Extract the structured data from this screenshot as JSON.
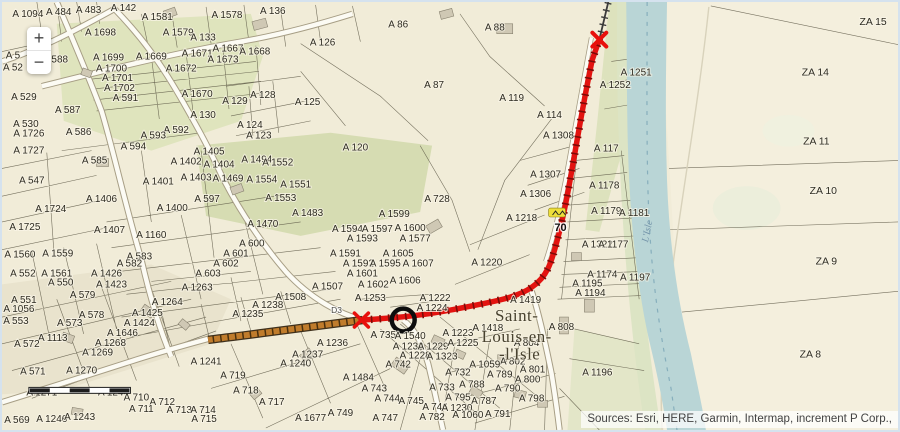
{
  "map": {
    "attribution": "Sources: Esri, HERE, Garmin, Intermap, increment P Corp.,",
    "controls": {
      "zoom_in": "+",
      "zoom_out": "−"
    },
    "route": {
      "shield_label": "70",
      "road_label": "D3"
    },
    "town_label": {
      "line1": "Saint-",
      "line2": "Louis-en-",
      "line3": "-l'Isle"
    },
    "river_label": "L'Isle",
    "colors": {
      "route_red": "#e31310",
      "route_orange": "#c07c2c",
      "river_blue": "#b9d5d6",
      "shield_yellow": "#eedf3a",
      "marker_black": "#0d0d0d"
    },
    "parcel_labels": [
      {
        "t": "A 1094",
        "x": 26,
        "y": 15
      },
      {
        "t": "A 484",
        "x": 57,
        "y": 13
      },
      {
        "t": "A 483",
        "x": 87,
        "y": 11
      },
      {
        "t": "A 142",
        "x": 122,
        "y": 9
      },
      {
        "t": "A 1581",
        "x": 156,
        "y": 18
      },
      {
        "t": "A 1578",
        "x": 226,
        "y": 16
      },
      {
        "t": "A 136",
        "x": 272,
        "y": 12
      },
      {
        "t": "A 1698",
        "x": 99,
        "y": 34
      },
      {
        "t": "A 1579",
        "x": 177,
        "y": 34
      },
      {
        "t": "A 133",
        "x": 202,
        "y": 39
      },
      {
        "t": "A 1699",
        "x": 107,
        "y": 59
      },
      {
        "t": "A 1669",
        "x": 150,
        "y": 58
      },
      {
        "t": "A 1671",
        "x": 196,
        "y": 55
      },
      {
        "t": "A 1667",
        "x": 227,
        "y": 50
      },
      {
        "t": "A 1668",
        "x": 254,
        "y": 53
      },
      {
        "t": "A 1673",
        "x": 222,
        "y": 61
      },
      {
        "t": "A 1672",
        "x": 180,
        "y": 70
      },
      {
        "t": "588",
        "x": 58,
        "y": 61
      },
      {
        "t": "A 5",
        "x": 11,
        "y": 57
      },
      {
        "t": "A 52",
        "x": 11,
        "y": 69
      },
      {
        "t": "A 1700",
        "x": 110,
        "y": 70
      },
      {
        "t": "A 1701",
        "x": 116,
        "y": 80
      },
      {
        "t": "A 1702",
        "x": 118,
        "y": 90
      },
      {
        "t": "A 591",
        "x": 124,
        "y": 100
      },
      {
        "t": "A 1670",
        "x": 196,
        "y": 96
      },
      {
        "t": "A 129",
        "x": 234,
        "y": 103
      },
      {
        "t": "A 128",
        "x": 262,
        "y": 97
      },
      {
        "t": "A 125",
        "x": 307,
        "y": 104
      },
      {
        "t": "A 126",
        "x": 322,
        "y": 44
      },
      {
        "t": "A 86",
        "x": 398,
        "y": 26
      },
      {
        "t": "A 88",
        "x": 495,
        "y": 29
      },
      {
        "t": "A 87",
        "x": 434,
        "y": 87
      },
      {
        "t": "A 119",
        "x": 512,
        "y": 100
      },
      {
        "t": "A 114",
        "x": 550,
        "y": 117
      },
      {
        "t": "A 1308",
        "x": 559,
        "y": 138
      },
      {
        "t": "A 529",
        "x": 22,
        "y": 99
      },
      {
        "t": "A 587",
        "x": 66,
        "y": 112
      },
      {
        "t": "A 130",
        "x": 202,
        "y": 117
      },
      {
        "t": "A 124",
        "x": 249,
        "y": 127
      },
      {
        "t": "A 123",
        "x": 258,
        "y": 138
      },
      {
        "t": "A 530",
        "x": 24,
        "y": 126
      },
      {
        "t": "A 1726",
        "x": 27,
        "y": 136
      },
      {
        "t": "A 586",
        "x": 77,
        "y": 134
      },
      {
        "t": "A 592",
        "x": 175,
        "y": 132
      },
      {
        "t": "A 593",
        "x": 152,
        "y": 138
      },
      {
        "t": "A 594",
        "x": 132,
        "y": 149
      },
      {
        "t": "A 1727",
        "x": 27,
        "y": 153
      },
      {
        "t": "A 547",
        "x": 30,
        "y": 183
      },
      {
        "t": "A 585",
        "x": 93,
        "y": 163
      },
      {
        "t": "A 1405",
        "x": 208,
        "y": 154
      },
      {
        "t": "A 1402",
        "x": 185,
        "y": 164
      },
      {
        "t": "A 1404",
        "x": 218,
        "y": 167
      },
      {
        "t": "A 1494",
        "x": 256,
        "y": 162
      },
      {
        "t": "A 1552",
        "x": 277,
        "y": 165
      },
      {
        "t": "A 1403",
        "x": 195,
        "y": 180
      },
      {
        "t": "A 1469",
        "x": 227,
        "y": 181
      },
      {
        "t": "A 1554",
        "x": 261,
        "y": 182
      },
      {
        "t": "A 1553",
        "x": 280,
        "y": 201
      },
      {
        "t": "A 1551",
        "x": 295,
        "y": 187
      },
      {
        "t": "A 1401",
        "x": 157,
        "y": 184
      },
      {
        "t": "A 1406",
        "x": 100,
        "y": 202
      },
      {
        "t": "A 597",
        "x": 206,
        "y": 202
      },
      {
        "t": "A 120",
        "x": 355,
        "y": 150
      },
      {
        "t": "A 1724",
        "x": 49,
        "y": 212
      },
      {
        "t": "A 1400",
        "x": 171,
        "y": 211
      },
      {
        "t": "A 1725",
        "x": 23,
        "y": 230
      },
      {
        "t": "A 1407",
        "x": 108,
        "y": 233
      },
      {
        "t": "A 1160",
        "x": 150,
        "y": 238
      },
      {
        "t": "A 1470",
        "x": 262,
        "y": 227
      },
      {
        "t": "A 1483",
        "x": 307,
        "y": 216
      },
      {
        "t": "A 728",
        "x": 437,
        "y": 202
      },
      {
        "t": "A 600",
        "x": 251,
        "y": 247
      },
      {
        "t": "A 1560",
        "x": 18,
        "y": 258
      },
      {
        "t": "A 1559",
        "x": 56,
        "y": 257
      },
      {
        "t": "A 583",
        "x": 138,
        "y": 260
      },
      {
        "t": "A 601",
        "x": 235,
        "y": 257
      },
      {
        "t": "A 602",
        "x": 225,
        "y": 267
      },
      {
        "t": "A 552",
        "x": 21,
        "y": 277
      },
      {
        "t": "A 1561",
        "x": 55,
        "y": 277
      },
      {
        "t": "A 582",
        "x": 128,
        "y": 267
      },
      {
        "t": "A 550",
        "x": 59,
        "y": 286
      },
      {
        "t": "A 1426",
        "x": 105,
        "y": 277
      },
      {
        "t": "A 603",
        "x": 207,
        "y": 277
      },
      {
        "t": "A 1423",
        "x": 110,
        "y": 288
      },
      {
        "t": "A 1599",
        "x": 394,
        "y": 217
      },
      {
        "t": "A 1594",
        "x": 347,
        "y": 232
      },
      {
        "t": "A 1597",
        "x": 377,
        "y": 232
      },
      {
        "t": "A 1600",
        "x": 410,
        "y": 231
      },
      {
        "t": "A 1593",
        "x": 362,
        "y": 242
      },
      {
        "t": "A 1577",
        "x": 415,
        "y": 242
      },
      {
        "t": "A 1591",
        "x": 345,
        "y": 257
      },
      {
        "t": "A 1605",
        "x": 398,
        "y": 257
      },
      {
        "t": "A 1592",
        "x": 358,
        "y": 267
      },
      {
        "t": "A 1595",
        "x": 385,
        "y": 267
      },
      {
        "t": "A 1607",
        "x": 418,
        "y": 267
      },
      {
        "t": "A 1601",
        "x": 362,
        "y": 277
      },
      {
        "t": "A 1606",
        "x": 405,
        "y": 284
      },
      {
        "t": "A 1602",
        "x": 373,
        "y": 288
      },
      {
        "t": "A 1507",
        "x": 327,
        "y": 290
      },
      {
        "t": "A 1508",
        "x": 290,
        "y": 301
      },
      {
        "t": "A 1307",
        "x": 546,
        "y": 177
      },
      {
        "t": "A 1306",
        "x": 536,
        "y": 197
      },
      {
        "t": "A 1218",
        "x": 522,
        "y": 221
      },
      {
        "t": "A 1220",
        "x": 487,
        "y": 266
      },
      {
        "t": "A 117",
        "x": 607,
        "y": 151
      },
      {
        "t": "A 1178",
        "x": 605,
        "y": 188
      },
      {
        "t": "A 1179",
        "x": 607,
        "y": 214
      },
      {
        "t": "A 1181",
        "x": 635,
        "y": 216
      },
      {
        "t": "A 1322",
        "x": 598,
        "y": 248
      },
      {
        "t": "A 1177",
        "x": 614,
        "y": 248
      },
      {
        "t": "A 1174",
        "x": 603,
        "y": 278
      },
      {
        "t": "A 1197",
        "x": 636,
        "y": 281
      },
      {
        "t": "A 1195",
        "x": 588,
        "y": 287
      },
      {
        "t": "A 1194",
        "x": 591,
        "y": 297
      },
      {
        "t": "A 1196",
        "x": 598,
        "y": 377
      },
      {
        "t": "A 1251",
        "x": 637,
        "y": 74
      },
      {
        "t": "A 1252",
        "x": 616,
        "y": 87
      },
      {
        "t": "A 579",
        "x": 81,
        "y": 299
      },
      {
        "t": "A 1263",
        "x": 196,
        "y": 291
      },
      {
        "t": "A 1264",
        "x": 166,
        "y": 306
      },
      {
        "t": "A 551",
        "x": 22,
        "y": 304
      },
      {
        "t": "A 1056",
        "x": 17,
        "y": 313
      },
      {
        "t": "A 1238",
        "x": 267,
        "y": 309
      },
      {
        "t": "A 1235",
        "x": 247,
        "y": 318
      },
      {
        "t": "A 553",
        "x": 14,
        "y": 325
      },
      {
        "t": "A 578",
        "x": 90,
        "y": 319
      },
      {
        "t": "A 1425",
        "x": 146,
        "y": 317
      },
      {
        "t": "A 573",
        "x": 68,
        "y": 327
      },
      {
        "t": "A 1424",
        "x": 138,
        "y": 327
      },
      {
        "t": "A 1113",
        "x": 51,
        "y": 342
      },
      {
        "t": "A 1646",
        "x": 121,
        "y": 337
      },
      {
        "t": "A 572",
        "x": 25,
        "y": 348
      },
      {
        "t": "A 1268",
        "x": 109,
        "y": 347
      },
      {
        "t": "A 1269",
        "x": 96,
        "y": 357
      },
      {
        "t": "A 571",
        "x": 31,
        "y": 376
      },
      {
        "t": "A 1270",
        "x": 80,
        "y": 375
      },
      {
        "t": "A 1241",
        "x": 205,
        "y": 366
      },
      {
        "t": "A 1240",
        "x": 295,
        "y": 368
      },
      {
        "t": "A 719",
        "x": 232,
        "y": 380
      },
      {
        "t": "A 1271",
        "x": 40,
        "y": 397
      },
      {
        "t": "A 1244",
        "x": 112,
        "y": 397
      },
      {
        "t": "A 710",
        "x": 135,
        "y": 402
      },
      {
        "t": "A 712",
        "x": 161,
        "y": 407
      },
      {
        "t": "A 718",
        "x": 245,
        "y": 395
      },
      {
        "t": "A 711",
        "x": 140,
        "y": 414
      },
      {
        "t": "A 717",
        "x": 271,
        "y": 407
      },
      {
        "t": "A 713",
        "x": 178,
        "y": 415
      },
      {
        "t": "A 714",
        "x": 202,
        "y": 415
      },
      {
        "t": "A 715",
        "x": 203,
        "y": 424
      },
      {
        "t": "A 569",
        "x": 15,
        "y": 425
      },
      {
        "t": "A 1246",
        "x": 50,
        "y": 424
      },
      {
        "t": "A 1243",
        "x": 78,
        "y": 422
      },
      {
        "t": "A 1253",
        "x": 370,
        "y": 302
      },
      {
        "t": "A 1222",
        "x": 435,
        "y": 302
      },
      {
        "t": "A 1224",
        "x": 432,
        "y": 312
      },
      {
        "t": "A 1419",
        "x": 526,
        "y": 304
      },
      {
        "t": "A 735",
        "x": 383,
        "y": 339
      },
      {
        "t": "A 1540",
        "x": 410,
        "y": 340
      },
      {
        "t": "A 1232",
        "x": 408,
        "y": 351
      },
      {
        "t": "A 1229",
        "x": 433,
        "y": 351
      },
      {
        "t": "A 1223",
        "x": 458,
        "y": 337
      },
      {
        "t": "A 1418",
        "x": 488,
        "y": 332
      },
      {
        "t": "A 1225",
        "x": 463,
        "y": 347
      },
      {
        "t": "A 1228",
        "x": 415,
        "y": 360
      },
      {
        "t": "A 1323",
        "x": 442,
        "y": 361
      },
      {
        "t": "A 808",
        "x": 562,
        "y": 331
      },
      {
        "t": "A 804",
        "x": 527,
        "y": 347
      },
      {
        "t": "A 802",
        "x": 513,
        "y": 366
      },
      {
        "t": "A 1059",
        "x": 485,
        "y": 369
      },
      {
        "t": "A 1236",
        "x": 332,
        "y": 347
      },
      {
        "t": "A 1237",
        "x": 307,
        "y": 359
      },
      {
        "t": "A 742",
        "x": 398,
        "y": 369
      },
      {
        "t": "A 732",
        "x": 458,
        "y": 377
      },
      {
        "t": "A 1484",
        "x": 358,
        "y": 382
      },
      {
        "t": "A 789",
        "x": 500,
        "y": 379
      },
      {
        "t": "A 801",
        "x": 533,
        "y": 374
      },
      {
        "t": "A 800",
        "x": 528,
        "y": 384
      },
      {
        "t": "A 743",
        "x": 374,
        "y": 393
      },
      {
        "t": "A 733",
        "x": 442,
        "y": 392
      },
      {
        "t": "A 788",
        "x": 472,
        "y": 389
      },
      {
        "t": "A 790",
        "x": 508,
        "y": 393
      },
      {
        "t": "A 798",
        "x": 532,
        "y": 403
      },
      {
        "t": "A 744",
        "x": 387,
        "y": 403
      },
      {
        "t": "A 745",
        "x": 411,
        "y": 406
      },
      {
        "t": "A 795",
        "x": 458,
        "y": 402
      },
      {
        "t": "A 787",
        "x": 484,
        "y": 406
      },
      {
        "t": "A 746",
        "x": 435,
        "y": 412
      },
      {
        "t": "A 1230",
        "x": 457,
        "y": 413
      },
      {
        "t": "A 749",
        "x": 340,
        "y": 418
      },
      {
        "t": "A 1677",
        "x": 310,
        "y": 423
      },
      {
        "t": "A 747",
        "x": 385,
        "y": 423
      },
      {
        "t": "A 782",
        "x": 432,
        "y": 422
      },
      {
        "t": "A 1060",
        "x": 468,
        "y": 420
      },
      {
        "t": "A 791",
        "x": 498,
        "y": 419
      }
    ],
    "za_labels": [
      {
        "t": "ZA 15",
        "x": 875,
        "y": 23
      },
      {
        "t": "ZA 14",
        "x": 817,
        "y": 74
      },
      {
        "t": "ZA 11",
        "x": 818,
        "y": 144
      },
      {
        "t": "ZA 10",
        "x": 825,
        "y": 194
      },
      {
        "t": "ZA 9",
        "x": 828,
        "y": 265
      },
      {
        "t": "ZA 8",
        "x": 812,
        "y": 359
      }
    ]
  }
}
